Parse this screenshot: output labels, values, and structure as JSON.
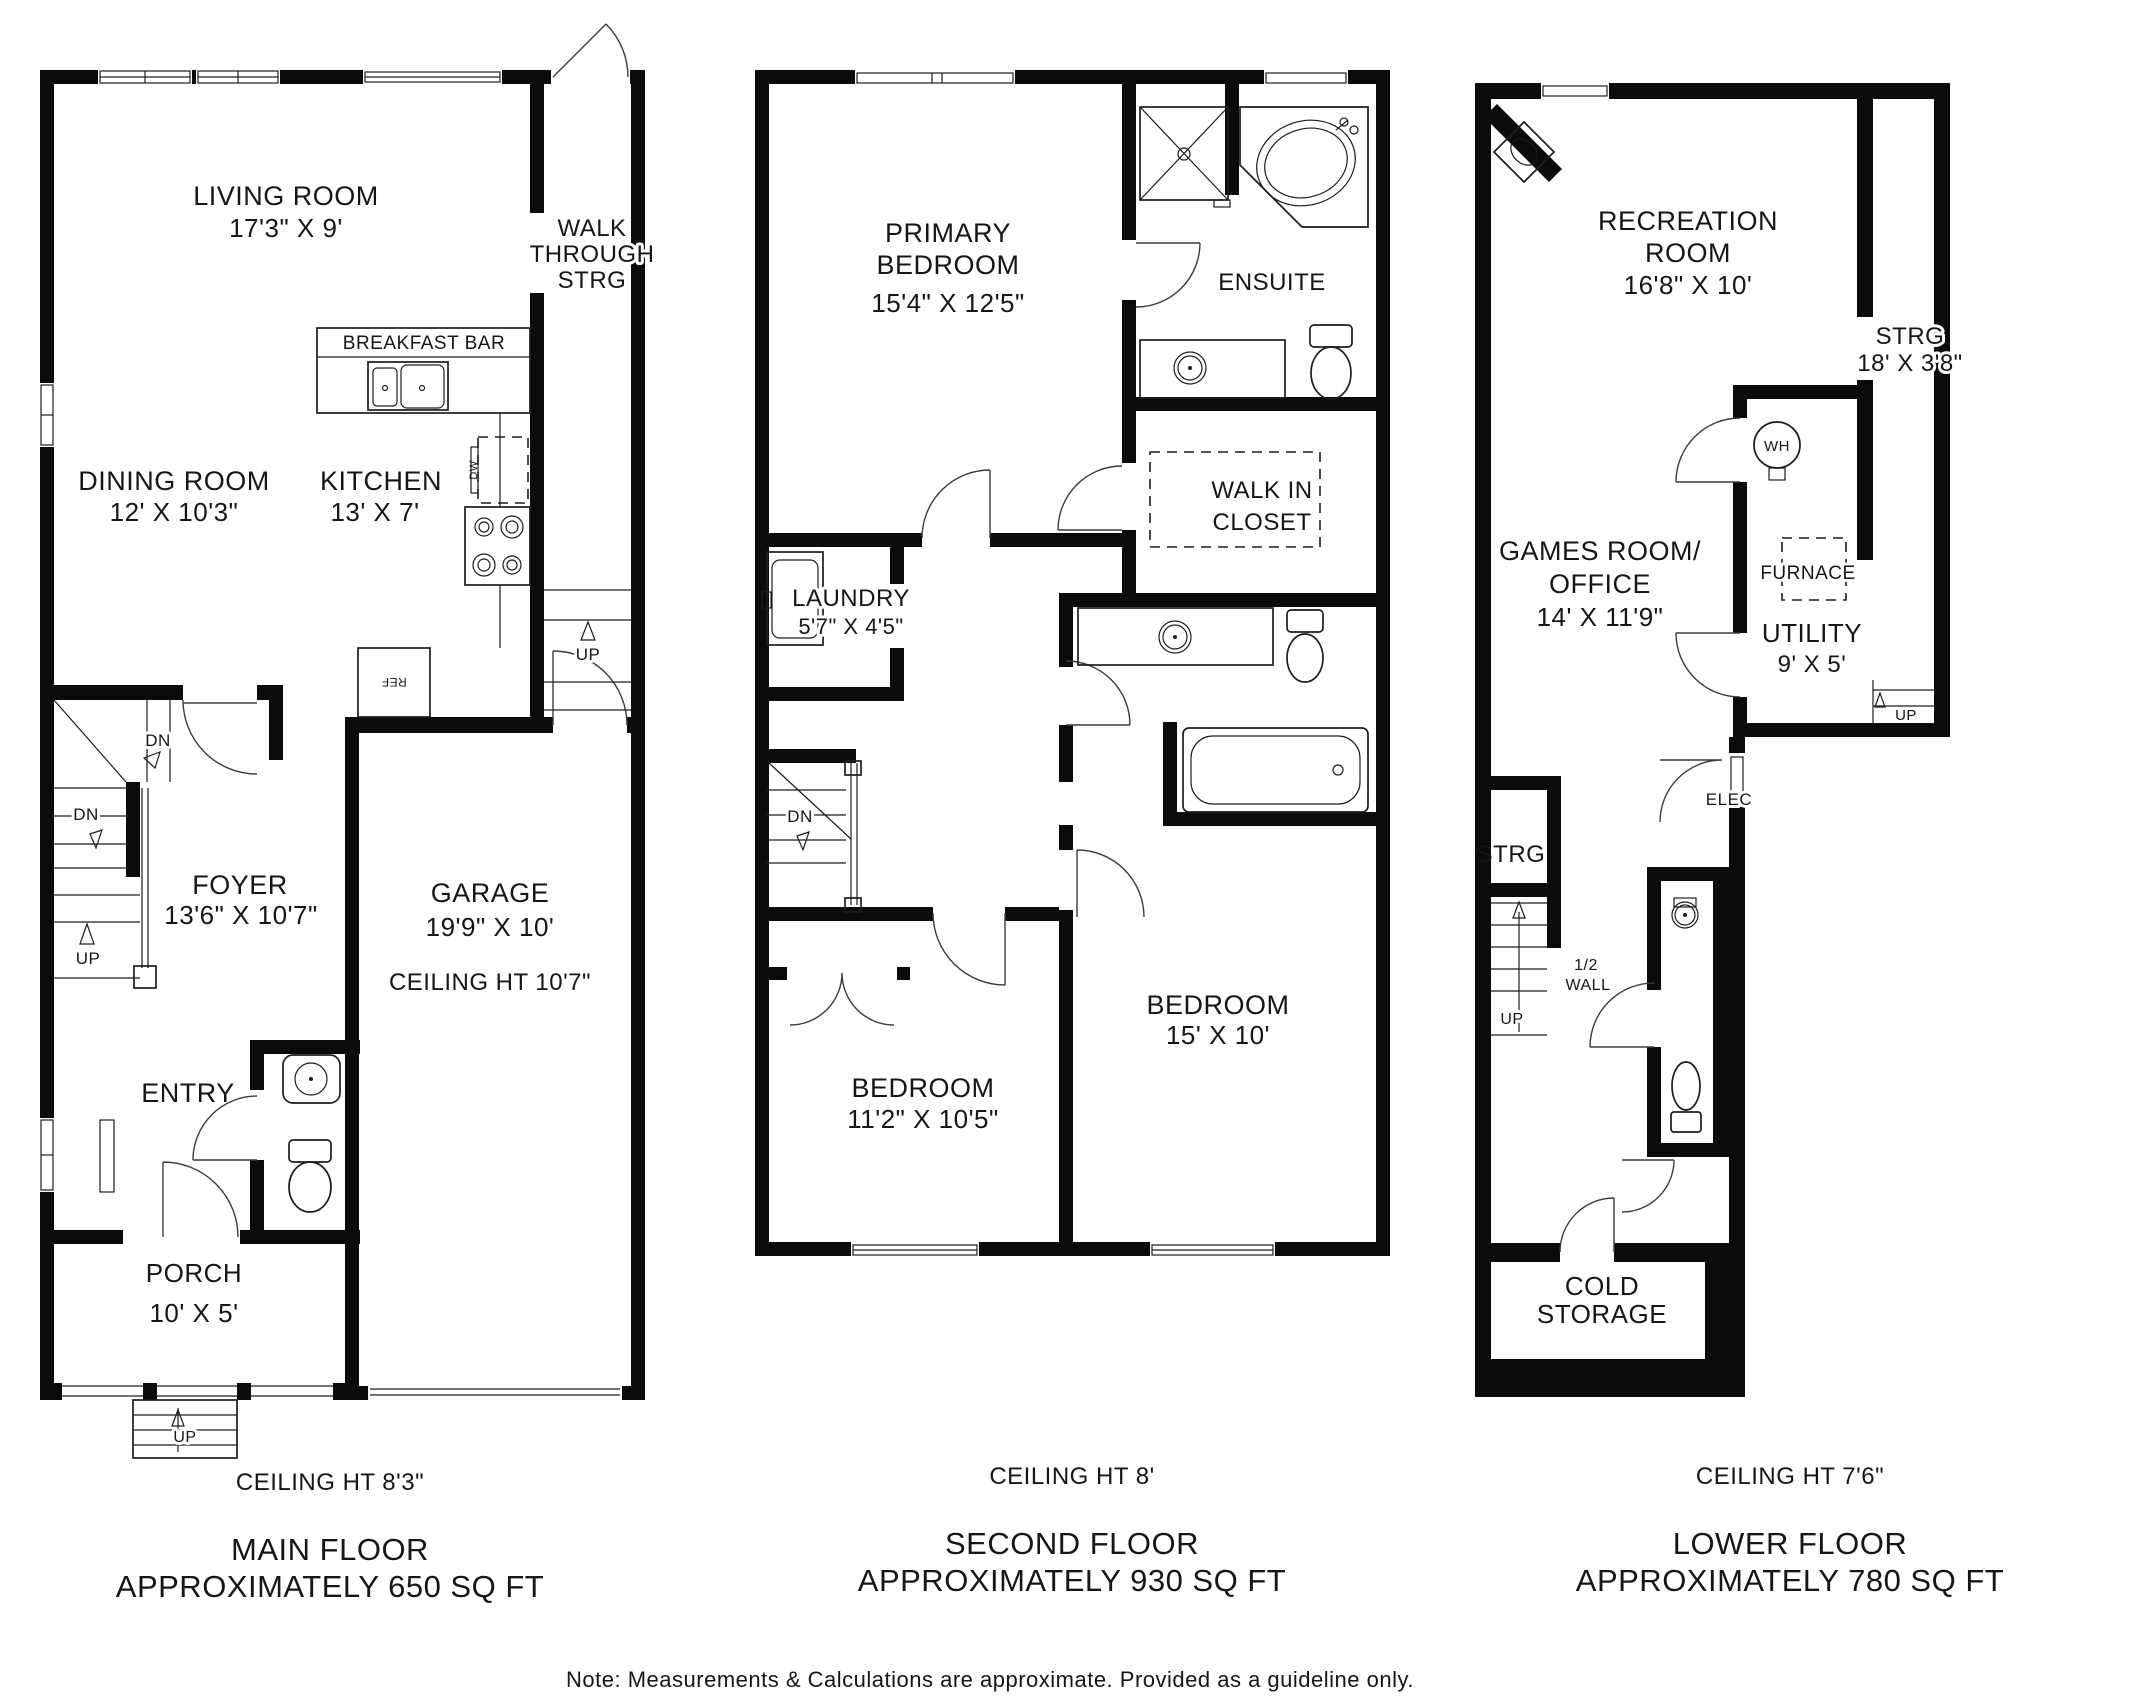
{
  "note": "Note: Measurements & Calculations are approximate. Provided as a guideline only.",
  "labels": {
    "up": "UP",
    "dn": "DN",
    "ref": "REF",
    "dw": "DW",
    "wh": "WH",
    "elec": "ELEC",
    "furnace": "FURNACE",
    "half_wall_line1": "1/2",
    "half_wall_line2": "WALL",
    "breakfast_bar": "BREAKFAST BAR"
  },
  "floors": [
    {
      "name": "MAIN FLOOR",
      "area": "APPROXIMATELY 650 SQ FT",
      "ceiling": "CEILING HT 8'3\"",
      "rooms": {
        "living": {
          "name": "LIVING ROOM",
          "dims": "17'3\" X 9'"
        },
        "walkthrough": {
          "line1": "WALK",
          "line2": "THROUGH",
          "line3": "STRG"
        },
        "dining": {
          "name": "DINING ROOM",
          "dims": "12' X 10'3\""
        },
        "kitchen": {
          "name": "KITCHEN",
          "dims": "13' X 7'"
        },
        "foyer": {
          "name": "FOYER",
          "dims": "13'6\" X 10'7\""
        },
        "garage": {
          "name": "GARAGE",
          "dims": "19'9\" X 10'",
          "ceiling": "CEILING HT 10'7\""
        },
        "entry": {
          "name": "ENTRY"
        },
        "porch": {
          "name": "PORCH",
          "dims": "10' X 5'"
        }
      }
    },
    {
      "name": "SECOND FLOOR",
      "area": "APPROXIMATELY 930 SQ FT",
      "ceiling": "CEILING HT 8'",
      "rooms": {
        "primary": {
          "line1": "PRIMARY",
          "line2": "BEDROOM",
          "dims": "15'4\" X 12'5\""
        },
        "ensuite": {
          "name": "ENSUITE"
        },
        "wic": {
          "line1": "WALK IN",
          "line2": "CLOSET"
        },
        "laundry": {
          "name": "LAUNDRY",
          "dims": "5'7\" X 4'5\""
        },
        "bedroom_left": {
          "name": "BEDROOM",
          "dims": "11'2\" X 10'5\""
        },
        "bedroom_right": {
          "name": "BEDROOM",
          "dims": "15' X 10'"
        }
      }
    },
    {
      "name": "LOWER FLOOR",
      "area": "APPROXIMATELY 780 SQ FT",
      "ceiling": "CEILING HT 7'6\"",
      "rooms": {
        "rec": {
          "line1": "RECREATION",
          "line2": "ROOM",
          "dims": "16'8\" X 10'"
        },
        "strg_right": {
          "name": "STRG",
          "dims": "18' X 3'8\""
        },
        "games": {
          "line1": "GAMES ROOM/",
          "line2": "OFFICE",
          "dims": "14' X 11'9\""
        },
        "utility": {
          "name": "UTILITY",
          "dims": "9' X 5'"
        },
        "strg_left": {
          "name": "STRG"
        },
        "cold": {
          "line1": "COLD",
          "line2": "STORAGE"
        }
      }
    }
  ]
}
